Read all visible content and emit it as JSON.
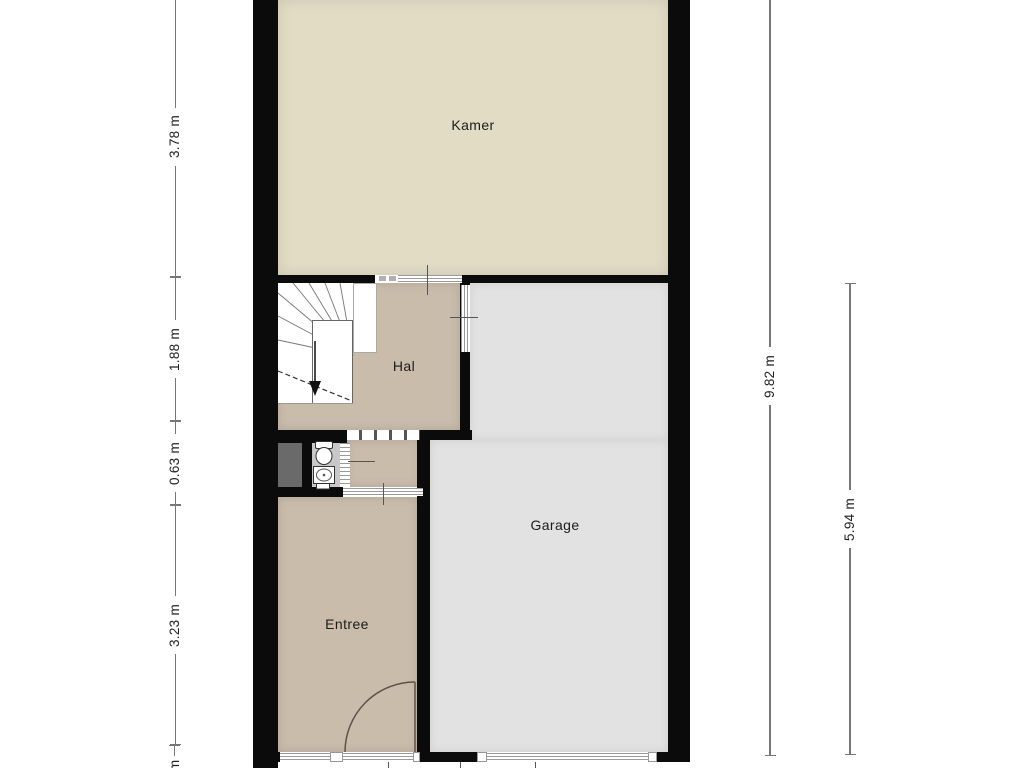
{
  "rooms": {
    "kamer": {
      "label": "Kamer"
    },
    "hal": {
      "label": "Hal"
    },
    "garage": {
      "label": "Garage"
    },
    "entree": {
      "label": "Entree"
    }
  },
  "dimensions": {
    "left": [
      {
        "value": "3.78 m"
      },
      {
        "value": "1.88 m"
      },
      {
        "value": "0.63 m"
      },
      {
        "value": "3.23 m"
      },
      {
        "value": "m"
      }
    ],
    "right": [
      {
        "value": "9.82 m"
      },
      {
        "value": "5.94 m"
      }
    ]
  },
  "colors": {
    "wall": "#0b0b0b",
    "kamer_floor": "#e2dcc5",
    "hall_floor": "#cabcab",
    "garage_floor": "#e2e2e2",
    "toilet_floor": "#c8c8c8",
    "shaft": "#6a6a6a",
    "dimension_line": "#777777",
    "label_text": "#1c1c1c"
  }
}
